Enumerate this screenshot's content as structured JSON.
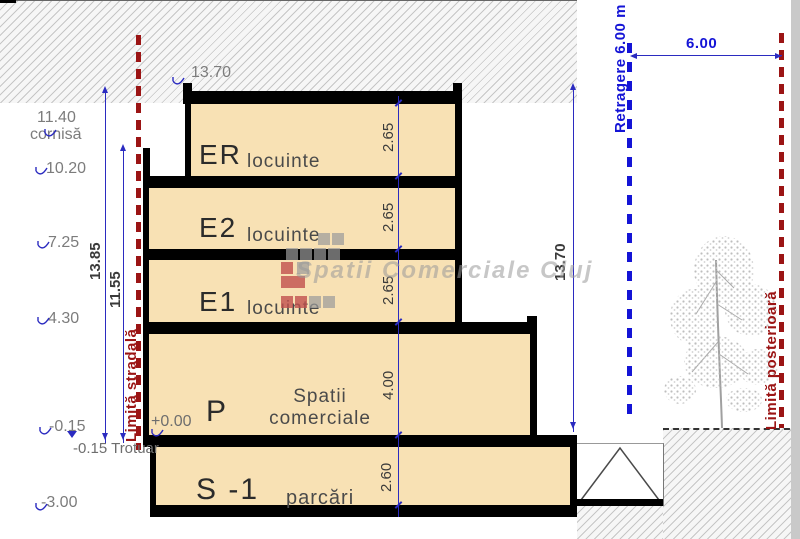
{
  "drawing": {
    "type": "building cross-section",
    "watermark": "Spatii Comerciale Cluj"
  },
  "floors": [
    {
      "code": "ER",
      "use": "locuinte",
      "height_m": "2.65"
    },
    {
      "code": "E2",
      "use": "locuinte",
      "height_m": "2.65"
    },
    {
      "code": "E1",
      "use": "locuinte",
      "height_m": "2.65"
    },
    {
      "code": "P",
      "use_line1": "Spatii",
      "use_line2": "comerciale",
      "height_m": "4.00"
    },
    {
      "code": "S -1",
      "use": "parcări",
      "height_m": "2.60"
    }
  ],
  "elevation_markers": {
    "roof_top": "13.70",
    "left": [
      {
        "value": "11.40",
        "label": "cornisă"
      },
      {
        "value": "10.20"
      },
      {
        "value": "7.25"
      },
      {
        "value": "4.30"
      },
      {
        "value": "-0.15"
      },
      {
        "value": "-3.00"
      }
    ]
  },
  "overall_dimensions": {
    "street_side_total": "13.85",
    "cornice_total": "11.55",
    "rear_side_total": "13.70",
    "setback_width": "6.00"
  },
  "boundaries": {
    "street": "Limită stradală",
    "rear": "Limită posterioară",
    "setback": "Retragere 6.00 m"
  },
  "ground": {
    "zero": "+0.00",
    "sidewalk": "-0.15 Trotuar"
  },
  "colors": {
    "floor_fill": "#F8E1B4",
    "structure": "#000000",
    "dimension_blue": "#2B2BC0",
    "setback_blue": "#1414D6",
    "boundary_red": "#9B1414",
    "label_gray": "#7C7C7C",
    "watermark_gray": "#9A9A9A"
  }
}
